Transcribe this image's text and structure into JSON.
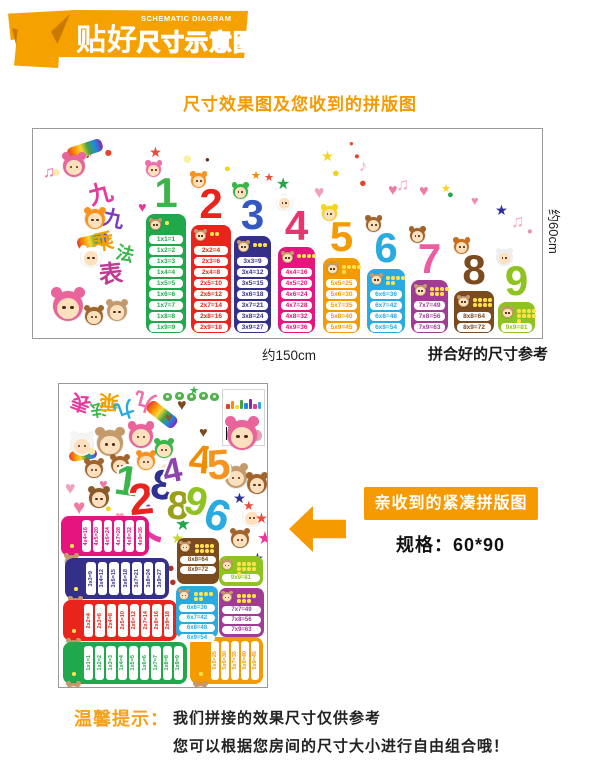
{
  "header": {
    "logo_main": "贴好",
    "logo_sub_en": "SCHEMATIC DIAGRAM",
    "logo_sub_cn": "尺寸示意图"
  },
  "subtitle": "尺寸效果图及您收到的拼版图",
  "poster": {
    "height_label": "约60cm",
    "width_label": "约150cm",
    "assembled_caption": "拼合好的尺寸参考",
    "title_chars": [
      {
        "t": "九",
        "c": "#e6399b",
        "x": 56,
        "y": 54,
        "s": 24,
        "r": -15
      },
      {
        "t": "九",
        "c": "#7a3bbf",
        "x": 70,
        "y": 80,
        "s": 21,
        "r": 12
      },
      {
        "t": "乘",
        "c": "#f5a100",
        "x": 60,
        "y": 103,
        "s": 21,
        "r": -8
      },
      {
        "t": "法",
        "c": "#3ab54a",
        "x": 83,
        "y": 116,
        "s": 18,
        "r": 14
      },
      {
        "t": "表",
        "c": "#c13b94",
        "x": 66,
        "y": 134,
        "s": 24,
        "r": -6
      }
    ],
    "columns": [
      {
        "num": "1",
        "x": 113,
        "w": 40,
        "color": "#1fa84c",
        "num_color": "#3ab54a",
        "chara": "#f06eaa",
        "rows": [
          "1x1=1",
          "1x2=2",
          "1x3=3",
          "1x4=4",
          "1x5=5",
          "1x6=6",
          "1x7=7",
          "1x8=8",
          "1x9=9"
        ]
      },
      {
        "num": "2",
        "x": 158,
        "w": 40,
        "color": "#e8241c",
        "num_color": "#e8241c",
        "chara": "#f7931e",
        "rows": [
          "2x2=4",
          "2x3=6",
          "2x4=8",
          "2x5=10",
          "2x6=12",
          "2x7=14",
          "2x8=16",
          "2x9=18"
        ]
      },
      {
        "num": "3",
        "x": 201,
        "w": 37,
        "color": "#343089",
        "num_color": "#3558c0",
        "chara": "#3ab54a",
        "rows": [
          "3x3=9",
          "3x4=12",
          "3x5=15",
          "3x6=18",
          "3x7=21",
          "3x8=24",
          "3x9=27"
        ]
      },
      {
        "num": "4",
        "x": 245,
        "w": 37,
        "color": "#e5147e",
        "num_color": "#e8356d",
        "chara": "#ffffff",
        "rows": [
          "4x4=16",
          "4x5=20",
          "4x6=24",
          "4x7=28",
          "4x8=32",
          "4x9=36"
        ]
      },
      {
        "num": "5",
        "x": 290,
        "w": 37,
        "color": "#f59a00",
        "num_color": "#f59a00",
        "chara": "#f7d417",
        "rows": [
          "5x5=25",
          "5x6=30",
          "5x7=35",
          "5x8=40",
          "5x9=45"
        ]
      },
      {
        "num": "6",
        "x": 334,
        "w": 38,
        "color": "#29abe2",
        "num_color": "#29abe2",
        "chara": "#a0642d",
        "rows": [
          "6x6=36",
          "6x7=42",
          "6x8=48",
          "6x9=54"
        ]
      },
      {
        "num": "7",
        "x": 378,
        "w": 37,
        "color": "#a03c96",
        "num_color": "#ef5ba1",
        "chara": "#a0642d",
        "rows": [
          "7x7=49",
          "7x8=56",
          "7x9=63"
        ]
      },
      {
        "num": "8",
        "x": 421,
        "w": 40,
        "color": "#7b4a1e",
        "num_color": "#7b4a1e",
        "chara": "#c96f1e",
        "rows": [
          "8x8=64",
          "8x9=72"
        ]
      },
      {
        "num": "9",
        "x": 465,
        "w": 37,
        "color": "#8fc31f",
        "num_color": "#8fc31f",
        "chara": "#eeeeee",
        "rows": [
          "9x9=81"
        ]
      }
    ],
    "decor": [
      {
        "g": "★",
        "c": "#e74c3c",
        "x": 36,
        "y": 16,
        "s": 11
      },
      {
        "g": "●",
        "c": "#fbe9a8",
        "x": 18,
        "y": 36,
        "s": 10
      },
      {
        "g": "♫",
        "c": "#f06eaa",
        "x": 10,
        "y": 36,
        "s": 10
      },
      {
        "g": "♪",
        "c": "#b71c1c",
        "x": 52,
        "y": 18,
        "s": 9
      },
      {
        "g": "●",
        "c": "#e8432b",
        "x": 71,
        "y": 17,
        "s": 9
      },
      {
        "g": "★",
        "c": "#e74c3c",
        "x": 116,
        "y": 17,
        "s": 9
      },
      {
        "g": "●",
        "c": "#faf0a0",
        "x": 149,
        "y": 21,
        "s": 11
      },
      {
        "g": "●",
        "c": "#5d2f14",
        "x": 172,
        "y": 27,
        "s": 5
      },
      {
        "g": "●",
        "c": "#f5d312",
        "x": 191,
        "y": 35,
        "s": 7
      },
      {
        "g": "★",
        "c": "#f08c00",
        "x": 218,
        "y": 42,
        "s": 7
      },
      {
        "g": "★",
        "c": "#e74c3c",
        "x": 231,
        "y": 44,
        "s": 7
      },
      {
        "g": "★",
        "c": "#21a84a",
        "x": 243,
        "y": 48,
        "s": 10
      },
      {
        "g": "♥",
        "c": "#e6399b",
        "x": 105,
        "y": 72,
        "s": 9
      },
      {
        "g": "★",
        "c": "#f7d41d",
        "x": 288,
        "y": 21,
        "s": 9
      },
      {
        "g": "●",
        "c": "#f5d312",
        "x": 299,
        "y": 38,
        "s": 8
      },
      {
        "g": "●",
        "c": "#e74c3c",
        "x": 316,
        "y": 11,
        "s": 5
      },
      {
        "g": "●",
        "c": "#e8432b",
        "x": 321,
        "y": 23,
        "s": 6
      },
      {
        "g": "♪",
        "c": "#f5a8c0",
        "x": 326,
        "y": 30,
        "s": 10
      },
      {
        "g": "●",
        "c": "#e8432b",
        "x": 326,
        "y": 48,
        "s": 8
      },
      {
        "g": "♥",
        "c": "#f2a0bb",
        "x": 281,
        "y": 55,
        "s": 11
      },
      {
        "g": "♥",
        "c": "#ef7ba5",
        "x": 355,
        "y": 54,
        "s": 10
      },
      {
        "g": "♫",
        "c": "#f5a8c0",
        "x": 363,
        "y": 47,
        "s": 11
      },
      {
        "g": "♥",
        "c": "#ef7ba5",
        "x": 386,
        "y": 55,
        "s": 10
      },
      {
        "g": "★",
        "c": "#f7d41d",
        "x": 408,
        "y": 55,
        "s": 7
      },
      {
        "g": "●",
        "c": "#21a84a",
        "x": 414,
        "y": 61,
        "s": 7
      },
      {
        "g": "♥",
        "c": "#f08cb0",
        "x": 438,
        "y": 66,
        "s": 8
      },
      {
        "g": "★",
        "c": "#2e3192",
        "x": 462,
        "y": 75,
        "s": 9
      },
      {
        "g": "♫",
        "c": "#f5a8c0",
        "x": 478,
        "y": 84,
        "s": 11
      },
      {
        "g": "●",
        "c": "#f08cb0",
        "x": 494,
        "y": 98,
        "s": 6
      }
    ],
    "charas": [
      {
        "x": 30,
        "y": 26,
        "s": 22,
        "c": "#e8649b"
      },
      {
        "x": 52,
        "y": 80,
        "s": 20,
        "c": "#f7931e"
      },
      {
        "x": 48,
        "y": 118,
        "s": 20,
        "c": "#ffffff"
      },
      {
        "x": 20,
        "y": 162,
        "s": 30,
        "c": "#e8649b"
      },
      {
        "x": 52,
        "y": 178,
        "s": 18,
        "c": "#a0642d"
      },
      {
        "x": 74,
        "y": 172,
        "s": 20,
        "c": "#c49a6c"
      }
    ],
    "rainbows": [
      {
        "x": 34,
        "y": 14,
        "w": 36,
        "h": 13,
        "r": -18
      },
      {
        "x": 44,
        "y": 106,
        "w": 32,
        "h": 12,
        "r": -12
      }
    ]
  },
  "sheet": {
    "title_chars": [
      {
        "t": "表",
        "c": "#e6399b",
        "x": 12,
        "y": 8,
        "s": 20,
        "r": 200
      },
      {
        "t": "法",
        "c": "#3ab54a",
        "x": 31,
        "y": 16,
        "s": 16,
        "r": 170
      },
      {
        "t": "乘",
        "c": "#f5a100",
        "x": 40,
        "y": 7,
        "s": 20,
        "r": 185
      },
      {
        "t": "九",
        "c": "#29abe2",
        "x": 55,
        "y": 15,
        "s": 20,
        "r": 160
      },
      {
        "t": "九",
        "c": "#f06eaa",
        "x": 75,
        "y": 6,
        "s": 22,
        "r": 195
      }
    ],
    "bubbles": [
      {
        "x": 104,
        "y": 9
      },
      {
        "x": 116,
        "y": 8
      },
      {
        "x": 128,
        "y": 9
      },
      {
        "x": 140,
        "y": 8
      },
      {
        "x": 151,
        "y": 9
      }
    ],
    "mini_bar_heights": [
      5,
      8,
      4,
      9,
      6,
      10,
      5,
      7
    ],
    "mini_bar_colors": [
      "#e53935",
      "#fb8c00",
      "#fdd835",
      "#43a047",
      "#1e88e5",
      "#8e24aa",
      "#e6399b",
      "#29abe2"
    ],
    "numerals": [
      {
        "t": "1",
        "c": "#3ab54a",
        "x": 56,
        "y": 78,
        "s": 42,
        "r": 8
      },
      {
        "t": "2",
        "c": "#e8241c",
        "x": 70,
        "y": 96,
        "s": 44,
        "r": -6
      },
      {
        "t": "3",
        "c": "#2e3192",
        "x": 92,
        "y": 82,
        "s": 42,
        "r": 10,
        "f": true
      },
      {
        "t": "4",
        "c": "#8e44ad",
        "x": 104,
        "y": 72,
        "s": 34,
        "r": -12
      },
      {
        "t": "4",
        "c": "#f08c00",
        "x": 130,
        "y": 58,
        "s": 40,
        "r": 6
      },
      {
        "t": "5",
        "c": "#f7931e",
        "x": 148,
        "y": 62,
        "s": 42,
        "r": -4
      },
      {
        "t": "8",
        "c": "#9aa018",
        "x": 108,
        "y": 104,
        "s": 40,
        "r": 5
      },
      {
        "t": "9",
        "c": "#8fc31f",
        "x": 126,
        "y": 100,
        "s": 40,
        "r": 14
      },
      {
        "t": "6",
        "c": "#29abe2",
        "x": 146,
        "y": 112,
        "s": 44,
        "r": 18
      },
      {
        "t": "7",
        "c": "#e6399b",
        "x": 80,
        "y": 134,
        "s": 38,
        "r": -78
      }
    ],
    "charas": [
      {
        "x": 12,
        "y": 50,
        "s": 22,
        "c": "#f5f5f5"
      },
      {
        "x": 38,
        "y": 46,
        "s": 26,
        "c": "#c49a6c"
      },
      {
        "x": 70,
        "y": 40,
        "s": 24,
        "c": "#e8649b"
      },
      {
        "x": 26,
        "y": 76,
        "s": 18,
        "c": "#a0642d"
      },
      {
        "x": 52,
        "y": 72,
        "s": 18,
        "c": "#a0642d"
      },
      {
        "x": 78,
        "y": 68,
        "s": 18,
        "c": "#f7931e"
      },
      {
        "x": 96,
        "y": 56,
        "s": 18,
        "c": "#3ab54a"
      },
      {
        "x": 100,
        "y": 76,
        "s": 16,
        "c": "#ffffff"
      },
      {
        "x": 30,
        "y": 104,
        "s": 20,
        "c": "#8a5a2a"
      },
      {
        "x": 168,
        "y": 36,
        "s": 30,
        "c": "#e8649b"
      },
      {
        "x": 166,
        "y": 82,
        "s": 22,
        "c": "#c49a6c"
      },
      {
        "x": 188,
        "y": 90,
        "s": 20,
        "c": "#a0642d"
      },
      {
        "x": 184,
        "y": 124,
        "s": 18,
        "c": "#ffffff"
      },
      {
        "x": 172,
        "y": 146,
        "s": 18,
        "c": "#a0642d"
      }
    ],
    "rainbows": [
      {
        "x": 86,
        "y": 24,
        "w": 34,
        "h": 13,
        "r": 38
      },
      {
        "x": 10,
        "y": 66,
        "w": 28,
        "h": 10,
        "r": -8
      }
    ],
    "shapes": [
      {
        "g": "♥",
        "c": "#f2a0bb",
        "x": 6,
        "y": 96,
        "s": 11
      },
      {
        "g": "♥",
        "c": "#ef7ba5",
        "x": 14,
        "y": 114,
        "s": 13
      },
      {
        "g": "♥",
        "c": "#ef7ba5",
        "x": 40,
        "y": 94,
        "s": 9
      },
      {
        "g": "♥",
        "c": "#f2a0bb",
        "x": 64,
        "y": 94,
        "s": 8
      },
      {
        "g": "♥",
        "c": "#ef7ba5",
        "x": 94,
        "y": 86,
        "s": 9
      },
      {
        "g": "♥",
        "c": "#f2a0bb",
        "x": 56,
        "y": 126,
        "s": 10
      },
      {
        "g": "♥",
        "c": "#ef7ba5",
        "x": 2,
        "y": 140,
        "s": 9
      },
      {
        "g": "♥",
        "c": "#7b4a1e",
        "x": 118,
        "y": 14,
        "s": 10
      },
      {
        "g": "♥",
        "c": "#7b4a1e",
        "x": 140,
        "y": 42,
        "s": 9
      },
      {
        "g": "♥",
        "c": "#8a5a2a",
        "x": 106,
        "y": 28,
        "s": 8
      },
      {
        "g": "●",
        "c": "#fbe9a8",
        "x": 28,
        "y": 60,
        "s": 10
      },
      {
        "g": "●",
        "c": "#f5d312",
        "x": 46,
        "y": 120,
        "s": 7
      },
      {
        "g": "●",
        "c": "#8e44ad",
        "x": 86,
        "y": 118,
        "s": 7
      },
      {
        "g": "●",
        "c": "#b03026",
        "x": 108,
        "y": 178,
        "s": 8
      },
      {
        "g": "●",
        "c": "#b03026",
        "x": 110,
        "y": 192,
        "s": 8
      },
      {
        "g": "●",
        "c": "#f08c00",
        "x": 96,
        "y": 152,
        "s": 6
      },
      {
        "g": "●",
        "c": "#f06eaa",
        "x": 66,
        "y": 148,
        "s": 6
      },
      {
        "g": "★",
        "c": "#21a84a",
        "x": 116,
        "y": 132,
        "s": 11
      },
      {
        "g": "★",
        "c": "#c8d42a",
        "x": 112,
        "y": 148,
        "s": 9
      },
      {
        "g": "★",
        "c": "#e74c3c",
        "x": 196,
        "y": 128,
        "s": 9
      },
      {
        "g": "★",
        "c": "#e6399b",
        "x": 198,
        "y": 146,
        "s": 11
      },
      {
        "g": "★",
        "c": "#2e3192",
        "x": 192,
        "y": 168,
        "s": 9
      },
      {
        "g": "★",
        "c": "#2e3192",
        "x": 174,
        "y": 108,
        "s": 9
      },
      {
        "g": "★",
        "c": "#e74c3c",
        "x": 184,
        "y": 116,
        "s": 8
      },
      {
        "g": "★",
        "c": "#3ab54a",
        "x": 130,
        "y": 2,
        "s": 7
      }
    ],
    "vblocks": [
      {
        "num": 4,
        "x": 2,
        "y": 132,
        "w": 88,
        "h": 40
      },
      {
        "num": 3,
        "x": 6,
        "y": 174,
        "w": 104,
        "h": 41
      },
      {
        "num": 2,
        "x": 4,
        "y": 216,
        "w": 114,
        "h": 41
      },
      {
        "num": 1,
        "x": 4,
        "y": 258,
        "w": 124,
        "h": 42
      },
      {
        "num": 5,
        "x": 131,
        "y": 253,
        "w": 73,
        "h": 47
      }
    ],
    "hblocks": [
      {
        "num": 8,
        "x": 118,
        "y": 154,
        "w": 42,
        "h": 46
      },
      {
        "num": 9,
        "x": 160,
        "y": 172,
        "w": 44,
        "h": 30
      },
      {
        "num": 6,
        "x": 117,
        "y": 202,
        "w": 42,
        "h": 52
      },
      {
        "num": 7,
        "x": 160,
        "y": 204,
        "w": 45,
        "h": 49
      }
    ]
  },
  "annotation": {
    "caption": "亲收到的紧凑拼版图",
    "spec": "规格：60*90"
  },
  "tips": {
    "label": "温馨提示：",
    "line1": "我们拼接的效果尺寸仅供参考",
    "line2": "您可以根据您房间的尺寸大小进行自由组合哦！"
  }
}
